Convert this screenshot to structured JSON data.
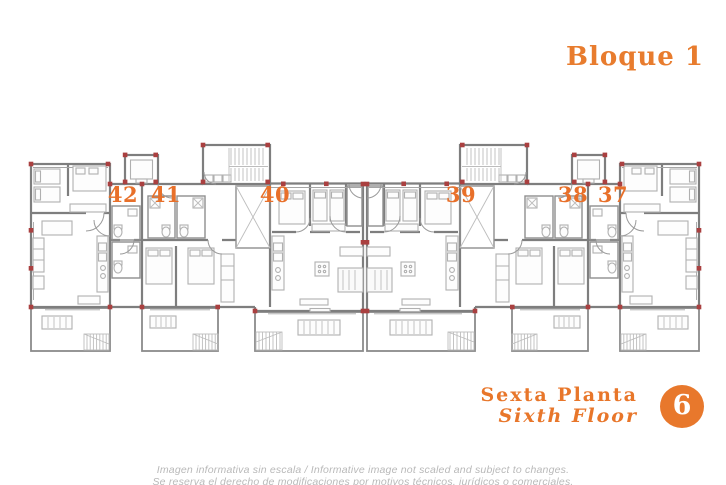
{
  "header": {
    "title": "Bloque 1"
  },
  "plan": {
    "units": [
      {
        "number": "42"
      },
      {
        "number": "41"
      },
      {
        "number": "40"
      },
      {
        "number": "39"
      },
      {
        "number": "38"
      },
      {
        "number": "37"
      }
    ]
  },
  "floor": {
    "label_es": "Sexta Planta",
    "label_en": "Sixth Floor",
    "badge_number": "6"
  },
  "footer": {
    "disclaimer_line1": "Imagen informativa sin escala /  Informative image not scaled and subject to changes.",
    "disclaimer_line2": "Se reserva el derecho de modificaciones por motivos técnicos, jurídicos o comerciales."
  },
  "colors": {
    "accent_orange": "#e8762a",
    "wall_gray": "#7e7e7e",
    "column_red": "#aa4040",
    "disclaimer_gray": "#b9b9b9"
  }
}
